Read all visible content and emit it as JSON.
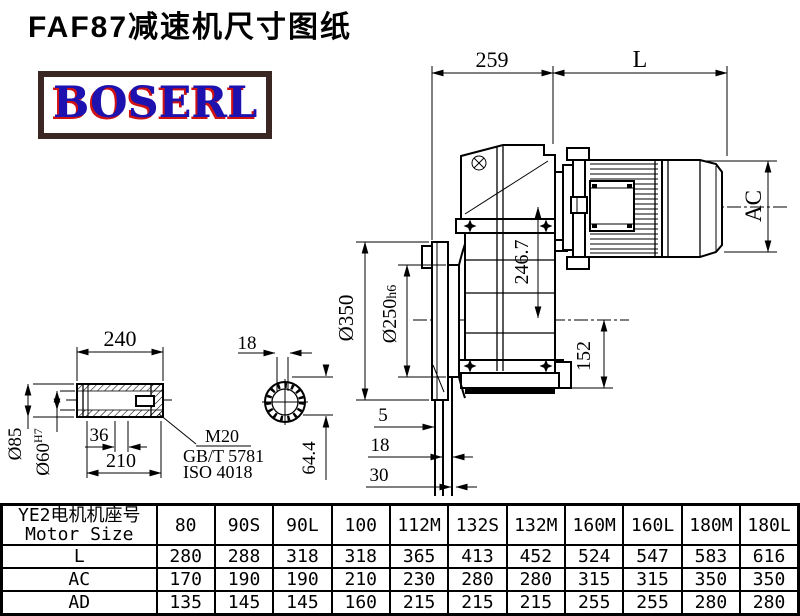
{
  "page": {
    "title": "FAF87减速机尺寸图纸",
    "logo_text": "BOSERL",
    "logo_color": "#1d12b0",
    "logo_shadow": "#d01212",
    "logo_border": "#3a2622"
  },
  "dims": {
    "top_width": "259",
    "motor_len": "L",
    "motor_dia": "AC",
    "center_height": "246.7",
    "base_height": "152",
    "flange_od": "Ø350",
    "spigot_base": "Ø250",
    "spigot_tol": "h6",
    "off1": "5",
    "off2": "18",
    "off3": "30"
  },
  "shaft": {
    "len": "240",
    "inner": "210",
    "step": "36",
    "od": "Ø85",
    "bore_base": "Ø60",
    "bore_tol": "H7",
    "thread": "M20",
    "std1": "GB/T 5781",
    "std2": "ISO 4018",
    "key_w": "18",
    "key_d": "64.4"
  },
  "table": {
    "header_cn": "YE2电机机座号",
    "header_en": "Motor Size",
    "columns": [
      "80",
      "90S",
      "90L",
      "100",
      "112M",
      "132S",
      "132M",
      "160M",
      "160L",
      "180M",
      "180L"
    ],
    "rows": [
      {
        "label": "L",
        "values": [
          "280",
          "288",
          "318",
          "318",
          "365",
          "413",
          "452",
          "524",
          "547",
          "583",
          "616"
        ]
      },
      {
        "label": "AC",
        "values": [
          "170",
          "190",
          "190",
          "210",
          "230",
          "280",
          "280",
          "315",
          "315",
          "350",
          "350"
        ]
      },
      {
        "label": "AD",
        "values": [
          "135",
          "145",
          "145",
          "160",
          "215",
          "215",
          "215",
          "255",
          "255",
          "280",
          "280"
        ]
      }
    ]
  }
}
